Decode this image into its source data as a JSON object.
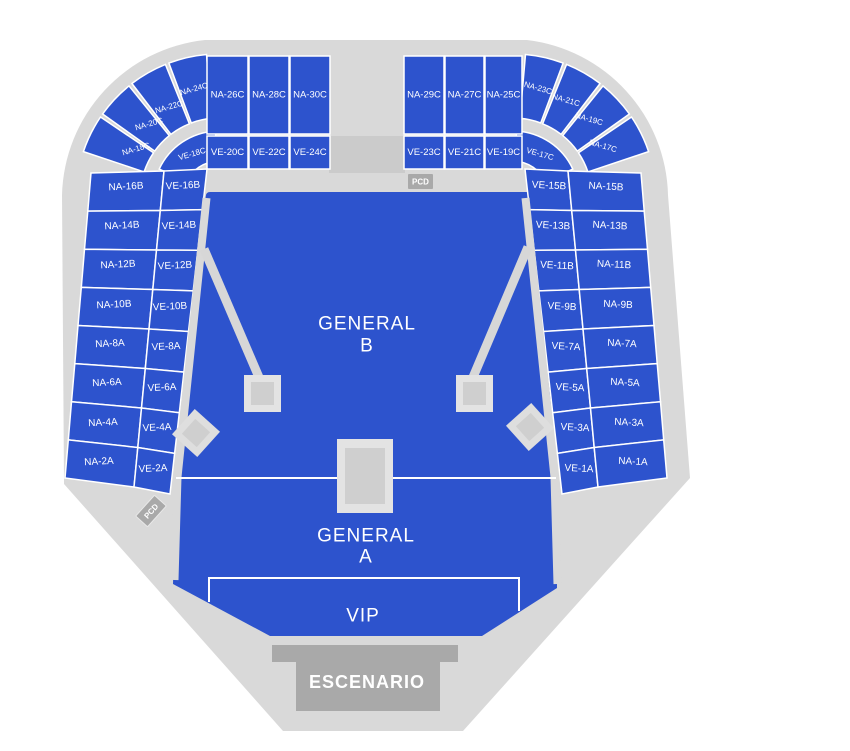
{
  "map": {
    "colors": {
      "section_blue": "#2d53cd",
      "floor_gray": "#d9d9d9",
      "walkway_gray": "#cbcbcb",
      "stage_gray": "#a9a9a9",
      "tower_outer_gray": "#e3e3e3",
      "tower_inner_gray": "#cfcfcf",
      "label_white": "#ffffff"
    },
    "fans": {
      "left_na": [
        "NA-24C",
        "NA-22C",
        "NA-20C",
        "NA-18C"
      ],
      "left_ve": "VE-18C",
      "right_na": [
        "NA-23C",
        "NA-21C",
        "NA-19C",
        "NA-17C"
      ],
      "right_ve": "VE-17C"
    },
    "blocks": {
      "left_na": [
        "NA-26C",
        "NA-28C",
        "NA-30C"
      ],
      "left_ve": [
        "VE-20C",
        "VE-22C",
        "VE-24C"
      ],
      "right_na": [
        "NA-29C",
        "NA-27C",
        "NA-25C"
      ],
      "right_ve": [
        "VE-23C",
        "VE-21C",
        "VE-19C"
      ]
    },
    "columns": {
      "left_na": [
        "NA-16B",
        "NA-14B",
        "NA-12B",
        "NA-10B",
        "NA-8A",
        "NA-6A",
        "NA-4A",
        "NA-2A"
      ],
      "left_ve": [
        "VE-16B",
        "VE-14B",
        "VE-12B",
        "VE-10B",
        "VE-8A",
        "VE-6A",
        "VE-4A",
        "VE-2A"
      ],
      "right_ve": [
        "VE-15B",
        "VE-13B",
        "VE-11B",
        "VE-9B",
        "VE-7A",
        "VE-5A",
        "VE-3A",
        "VE-1A"
      ],
      "right_na": [
        "NA-15B",
        "NA-13B",
        "NA-11B",
        "NA-9B",
        "NA-7A",
        "NA-5A",
        "NA-3A",
        "NA-1A"
      ]
    },
    "field": {
      "general_b": [
        "GENERAL",
        "B"
      ],
      "general_a": [
        "GENERAL",
        "A"
      ],
      "vip": "VIP"
    },
    "stage_label": "ESCENARIO",
    "badges": {
      "pcd_top": "PCD",
      "pcd_left": "PCD"
    }
  }
}
